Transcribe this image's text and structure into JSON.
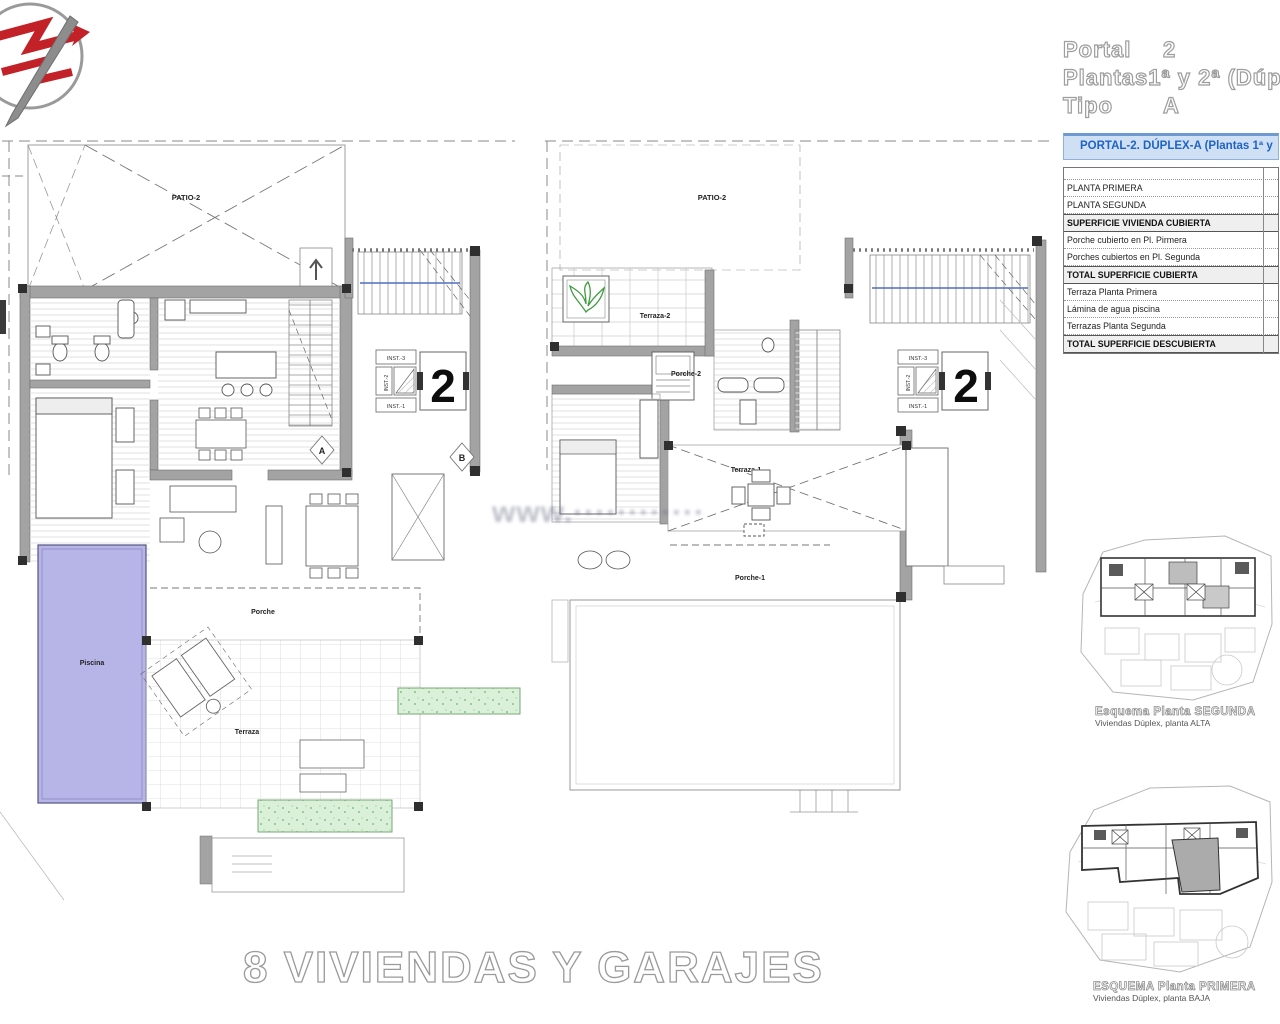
{
  "header": {
    "rows": [
      {
        "label": "Portal",
        "value": "2"
      },
      {
        "label": "Plantas",
        "value": "1ª y 2ª (Dúp"
      },
      {
        "label": "Tipo",
        "value": "A"
      }
    ]
  },
  "summary_table": {
    "title": "PORTAL-2. DÚPLEX-A (Plantas 1ª y",
    "rows": [
      "",
      "PLANTA PRIMERA",
      "PLANTA SEGUNDA",
      "SUPERFICIE VIVIENDA CUBIERTA",
      "Porche cubierto en Pl. Pirmera",
      "Porches cubiertos en Pl. Segunda",
      "TOTAL SUPERFICIE CUBIERTA",
      "Terraza Planta Primera",
      "Lámina de agua piscina",
      "Terrazas Planta Segunda",
      "TOTAL SUPERFICIE DESCUBIERTA"
    ]
  },
  "plan_left": {
    "patio": "PATIO-2",
    "porche": "Porche",
    "piscina": "Piscina",
    "terraza": "Terraza",
    "inst1": "INST.-1",
    "inst2": "INST.-2",
    "inst3": "INST.-3",
    "unit_number": "2",
    "stair_marker_a": "A",
    "stair_marker_b": "B"
  },
  "plan_middle": {
    "patio": "PATIO-2",
    "terraza2": "Terraza-2",
    "porche2": "Porche-2",
    "terraza1": "Terraza-1",
    "porche1": "Porche-1",
    "inst1": "INST.-1",
    "inst2": "INST.-2",
    "inst3": "INST.-3",
    "unit_number": "2"
  },
  "site_diagrams": [
    {
      "title": "Esquema Planta SEGUNDA",
      "subtitle": "Viviendas Dúplex, planta ALTA"
    },
    {
      "title": "ESQUEMA Planta PRIMERA",
      "subtitle": "Viviendas Dúplex, planta BAJA"
    }
  ],
  "footer": {
    "title": "8 VIVIENDAS Y GARAJES"
  },
  "watermark": {
    "text": "www.············"
  },
  "colors": {
    "pool": "#b7b5e8",
    "green_area": "#daf0d8",
    "wall_gray": "#a3a3a3",
    "table_header_bg": "#cfe0f4",
    "table_header_text": "#1f63c5"
  }
}
